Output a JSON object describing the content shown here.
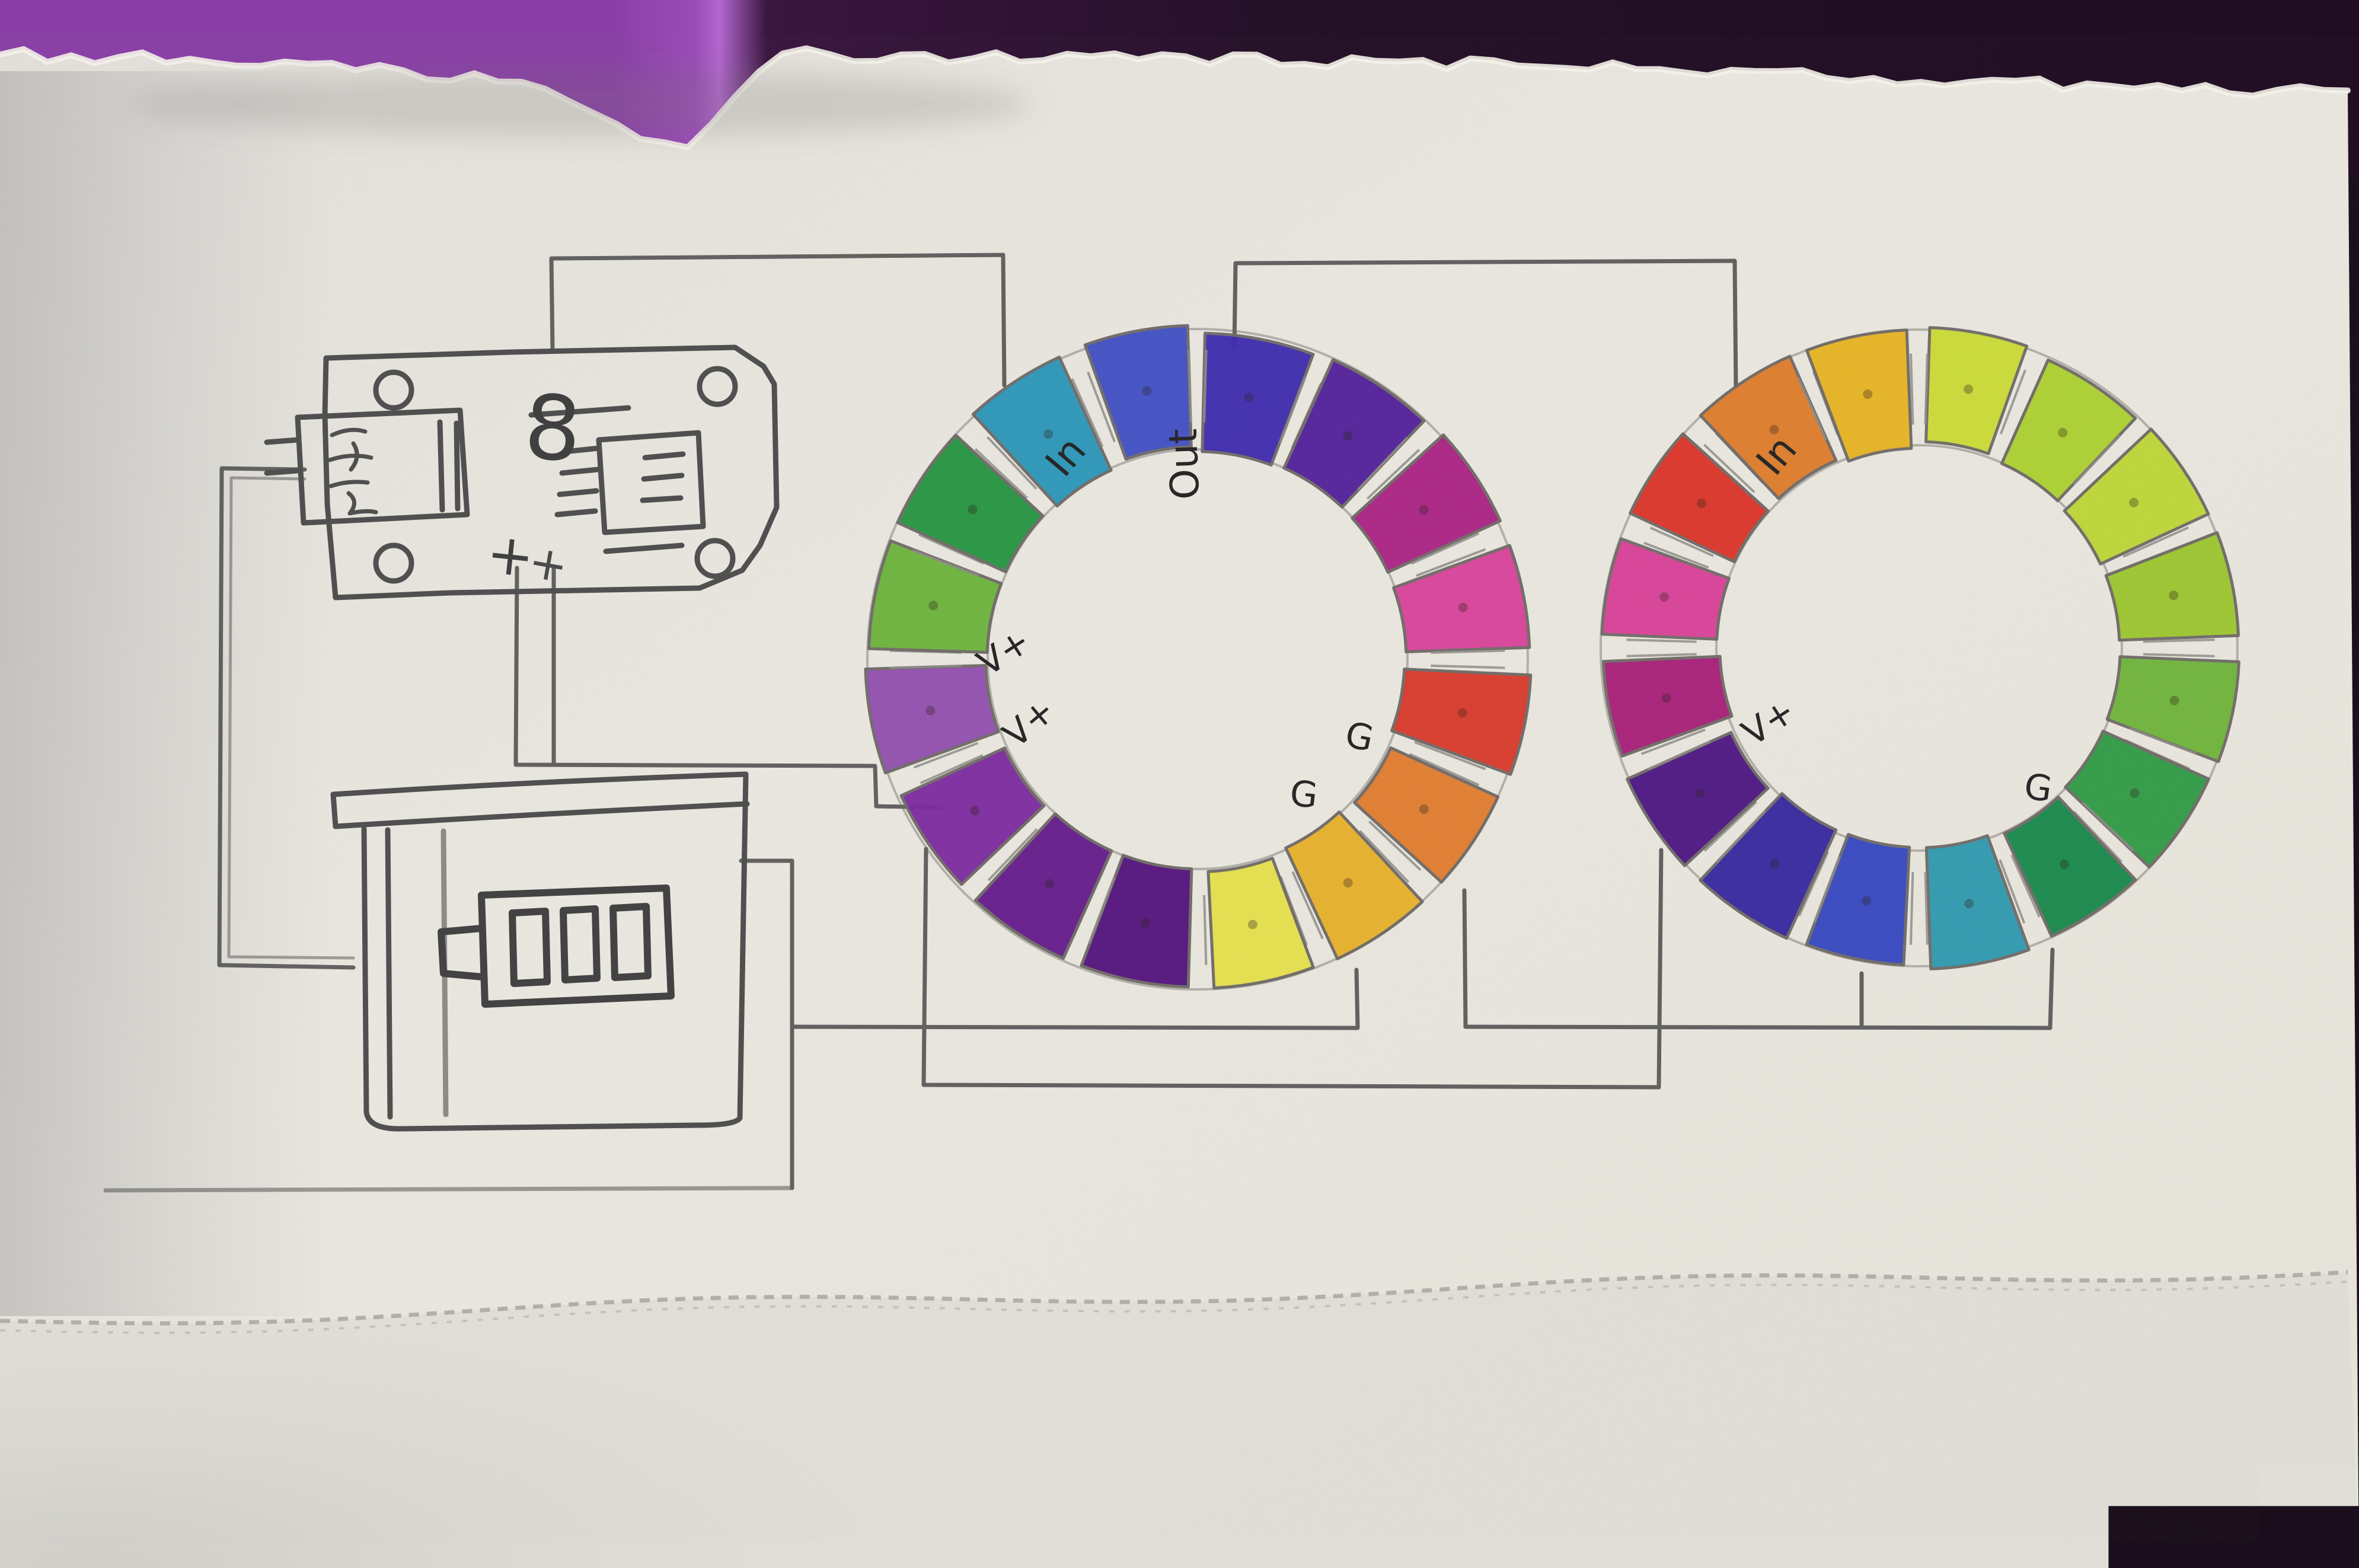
{
  "colors": {
    "paper": "#e9e7df",
    "paper_edge_fiber": "#f4f2ea",
    "paper_below_fold": "#dcdad3",
    "fold_speckle": "#a9a7a0",
    "desk_purple": "#8a3fa6",
    "desk_purple_highlight": "#b266cf",
    "desk_dark": "#241027",
    "pencil": "#4f4f4f",
    "pencil_light": "#8a8a8a",
    "ink": "#262626",
    "segment_outline": "#6f6a66"
  },
  "board": {
    "silkscreen_label": "8",
    "plus_labels": [
      "+",
      "+"
    ]
  },
  "rings": [
    {
      "name": "ring1",
      "led_count": 16,
      "labels": [
        {
          "id": "in",
          "text": "In"
        },
        {
          "id": "out",
          "text": "Out"
        },
        {
          "id": "vplus1",
          "text": "V+"
        },
        {
          "id": "vplus2",
          "text": "V+"
        },
        {
          "id": "g1",
          "text": "G"
        },
        {
          "id": "g2",
          "text": "G"
        }
      ],
      "segments": [
        "#3f2cae",
        "#52219b",
        "#aa2384",
        "#d8439b",
        "#d93a2b",
        "#e07c2e",
        "#e7b02a",
        "#e5e04b",
        "#54137d",
        "#651c8c",
        "#7c2ba0",
        "#9150ae",
        "#6cb33c",
        "#259441",
        "#2b96b9",
        "#4150c4"
      ]
    },
    {
      "name": "ring2",
      "led_count": 16,
      "labels": [
        {
          "id": "in",
          "text": "In"
        },
        {
          "id": "vplus1",
          "text": "V+"
        },
        {
          "id": "g1",
          "text": "G"
        }
      ],
      "segments": [
        "#c9da35",
        "#abd02f",
        "#bcd636",
        "#9cc52e",
        "#6fb43a",
        "#2f9b44",
        "#17894a",
        "#2f9aae",
        "#3647c0",
        "#37289f",
        "#4c1683",
        "#a81f78",
        "#d84097",
        "#da3428",
        "#dd7b2a",
        "#e5b322"
      ]
    }
  ]
}
